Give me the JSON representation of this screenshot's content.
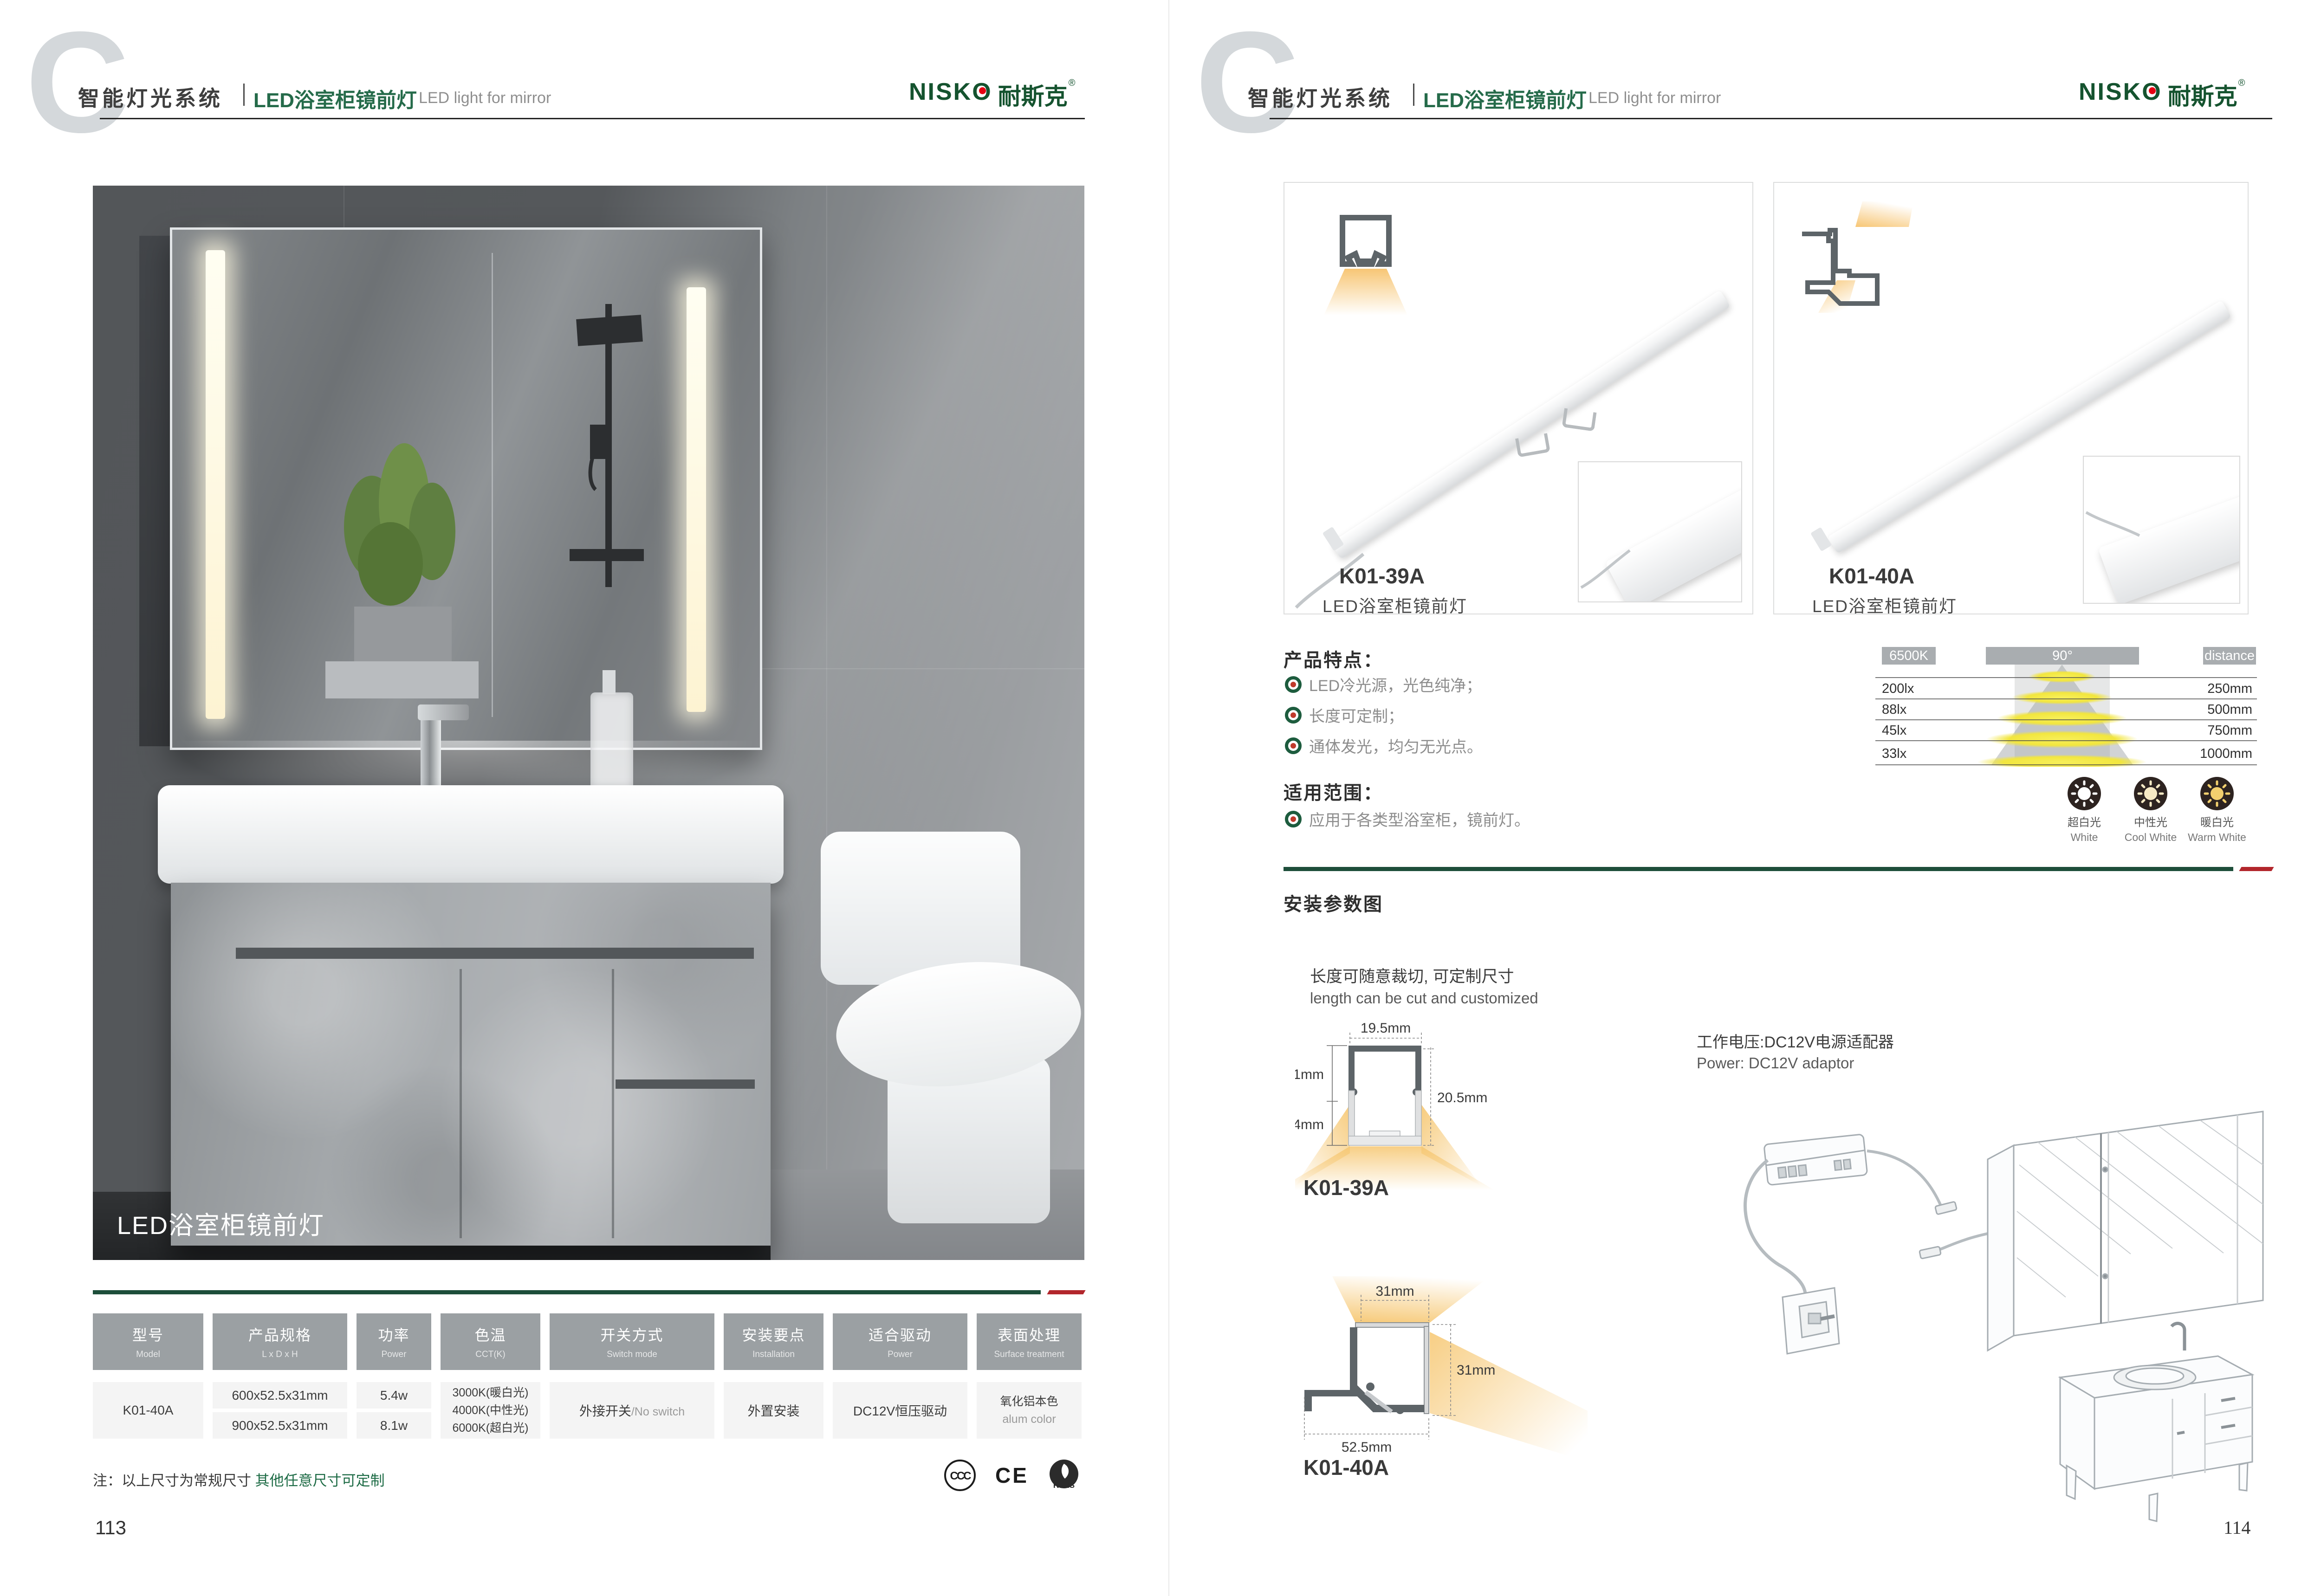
{
  "colors": {
    "brand-green": "#15532f",
    "title-green": "#256b4a",
    "sep-green": "#1d4e3a",
    "sep-red": "#b2262c",
    "note-green": "#1d6b45",
    "logo-red": "#e60012",
    "table-header-bg": "#9ba0a3",
    "cell-bg": "#f4f4f4",
    "glow-orange": "#f6c66f"
  },
  "brand": {
    "logo_en": "NISKO",
    "logo_cn": "耐斯克",
    "reg": "®"
  },
  "header": {
    "letter": "C",
    "section_cn": "智能灯光系统",
    "title_cn": "LED浴室柜镜前灯",
    "title_en": "LED light for mirror"
  },
  "left_page": {
    "photo_caption": "LED浴室柜镜前灯",
    "table": {
      "headers": [
        {
          "cn": "型号",
          "en": "Model"
        },
        {
          "cn": "产品规格",
          "en": "L x D x H"
        },
        {
          "cn": "功率",
          "en": "Power"
        },
        {
          "cn": "色温",
          "en": "CCT(K)"
        },
        {
          "cn": "开关方式",
          "en": "Switch mode"
        },
        {
          "cn": "安装要点",
          "en": "Installation"
        },
        {
          "cn": "适合驱动",
          "en": "Power"
        },
        {
          "cn": "表面处理",
          "en": "Surface treatment"
        }
      ],
      "model": "K01-40A",
      "spec_rows": [
        {
          "size": "600x52.5x31mm",
          "power": "5.4w"
        },
        {
          "size": "900x52.5x31mm",
          "power": "8.1w"
        }
      ],
      "cct": [
        "3000K(暖白光)",
        "4000K(中性光)",
        "6000K(超白光)"
      ],
      "switch_cn": "外接开关",
      "switch_en": "/No switch",
      "installation": "外置安装",
      "driver": "DC12V恒压驱动",
      "surface_cn": "氧化铝本色",
      "surface_en": "alum color"
    },
    "note_prefix": "注：以上尺寸为常规尺寸 ",
    "note_green": "其他任意尺寸可定制",
    "certs": {
      "ccc": "CCC",
      "ce": "CE",
      "rohs": "RoHS"
    },
    "page_number": "113"
  },
  "right_page": {
    "products": [
      {
        "model": "K01-39A",
        "name": "LED浴室柜镜前灯"
      },
      {
        "model": "K01-40A",
        "name": "LED浴室柜镜前灯"
      }
    ],
    "features": {
      "title": "产品特点：",
      "items": [
        "LED冷光源，光色纯净；",
        "长度可定制；",
        "通体发光，均匀无光点。"
      ]
    },
    "application": {
      "title": "适用范围：",
      "items": [
        "应用于各类型浴室柜，镜前灯。"
      ]
    },
    "photometric": {
      "cct": "6500K",
      "angle": "90°",
      "distance_label": "distance",
      "rows": [
        {
          "lux": "200lx",
          "distance": "250mm"
        },
        {
          "lux": "88lx",
          "distance": "500mm"
        },
        {
          "lux": "45lx",
          "distance": "750mm"
        },
        {
          "lux": "33lx",
          "distance": "1000mm"
        }
      ]
    },
    "cct_options": [
      {
        "cn": "超白光",
        "en": "White"
      },
      {
        "cn": "中性光",
        "en": "Cool White"
      },
      {
        "cn": "暖白光",
        "en": "Warm White"
      }
    ],
    "install": {
      "title": "安装参数图",
      "cut_cn": "长度可随意裁切, 可定制尺寸",
      "cut_en": "length can be cut and customized",
      "power_cn": "工作电压:DC12V电源适配器",
      "power_en": "Power: DC12V adaptor",
      "k0139a": {
        "label": "K01-39A",
        "width": "19.5mm",
        "upper": "9.1mm",
        "lower": "11.4mm",
        "height": "20.5mm"
      },
      "k0140a": {
        "label": "K01-40A",
        "top": "31mm",
        "side": "31mm",
        "bottom": "52.5mm"
      }
    },
    "page_number": "114"
  }
}
